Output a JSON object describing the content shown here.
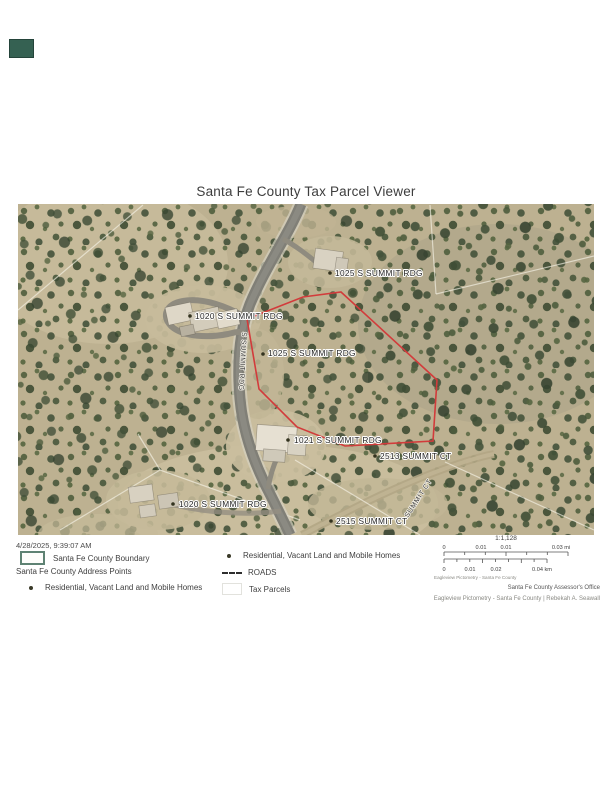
{
  "page": {
    "title": "Santa Fe County Tax Parcel Viewer",
    "timestamp": "4/28/2025, 9:39:07 AM"
  },
  "map": {
    "highlight_color": "#d23b3b",
    "labels": {
      "parcel_1025_top": "1025 S SUMMIT RDG",
      "parcel_1020_upper": "1020 S SUMMIT RDG",
      "parcel_1025_center": "1025 S SUMMIT RDG",
      "parcel_1021": "1021 S SUMMIT RDG",
      "parcel_2513": "2513 SUMMIT CT",
      "parcel_1020_lower": "1020 S SUMMIT RDG",
      "parcel_2515": "2515 SUMMIT CT",
      "road_s_summit": "S SUMMIT RDG",
      "road_summit_ct": "SUMMIT CT"
    }
  },
  "legend": {
    "county_boundary": "Santa Fe County Boundary",
    "address_points_header": "Santa Fe County Address Points",
    "residential_left": "Residential, Vacant Land and Mobile Homes",
    "residential_right": "Residential, Vacant Land and Mobile Homes",
    "roads": "ROADS",
    "tax_parcels": "Tax Parcels"
  },
  "scalebar": {
    "ratio": "1:1,128",
    "mi": [
      "0",
      "0.01",
      "0.01",
      "0.03 mi"
    ],
    "km": [
      "0",
      "0.01",
      "0.02",
      "0.04 km"
    ],
    "credit": "Eagleview Pictometry - Santa Fe County"
  },
  "footer": {
    "office": "Santa Fe County Assessor's Office",
    "credit": "Eagleview Pictometry - Santa Fe County | Rebekah A. Seawall"
  }
}
